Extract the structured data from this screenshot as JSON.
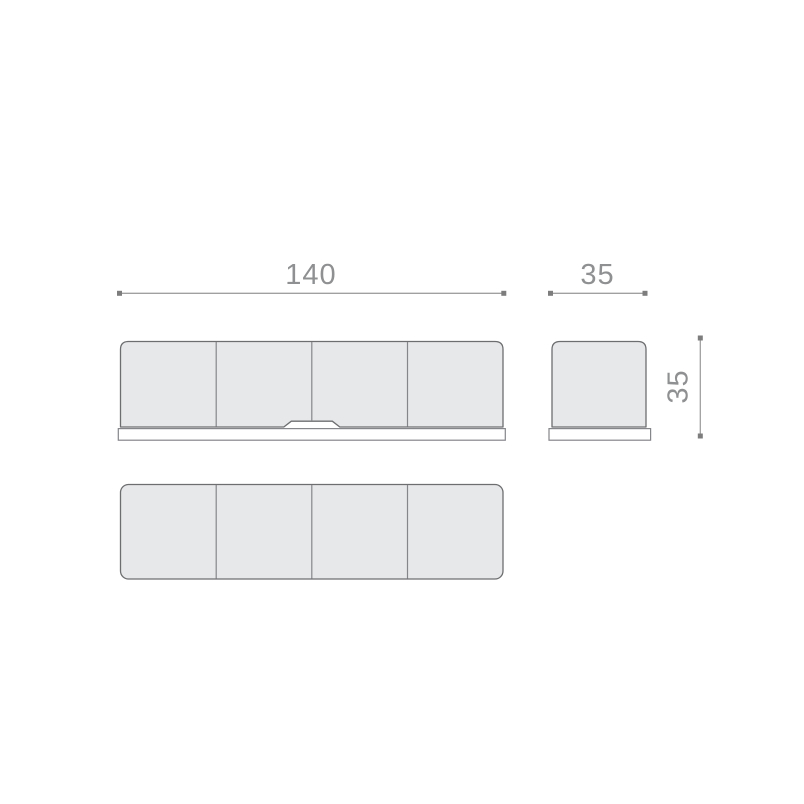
{
  "drawing": {
    "dimensions": {
      "width": {
        "label": "140"
      },
      "depth": {
        "label": "35"
      },
      "height": {
        "label": "35"
      }
    },
    "views": {
      "front": {
        "panel_count": 4
      },
      "side": {
        "panel_count": 1
      },
      "top": {
        "panel_count": 4
      }
    },
    "colors": {
      "background": "#ffffff",
      "panel_fill": "#e7e8e9",
      "panel_stroke": "#6d6e70",
      "divider_stroke": "#85868a",
      "base_fill": "#ffffff",
      "base_stroke": "#85868a",
      "dimension_line": "#a0a0a0",
      "dimension_marker": "#7d7d7d",
      "dimension_text": "#8f9091"
    }
  }
}
